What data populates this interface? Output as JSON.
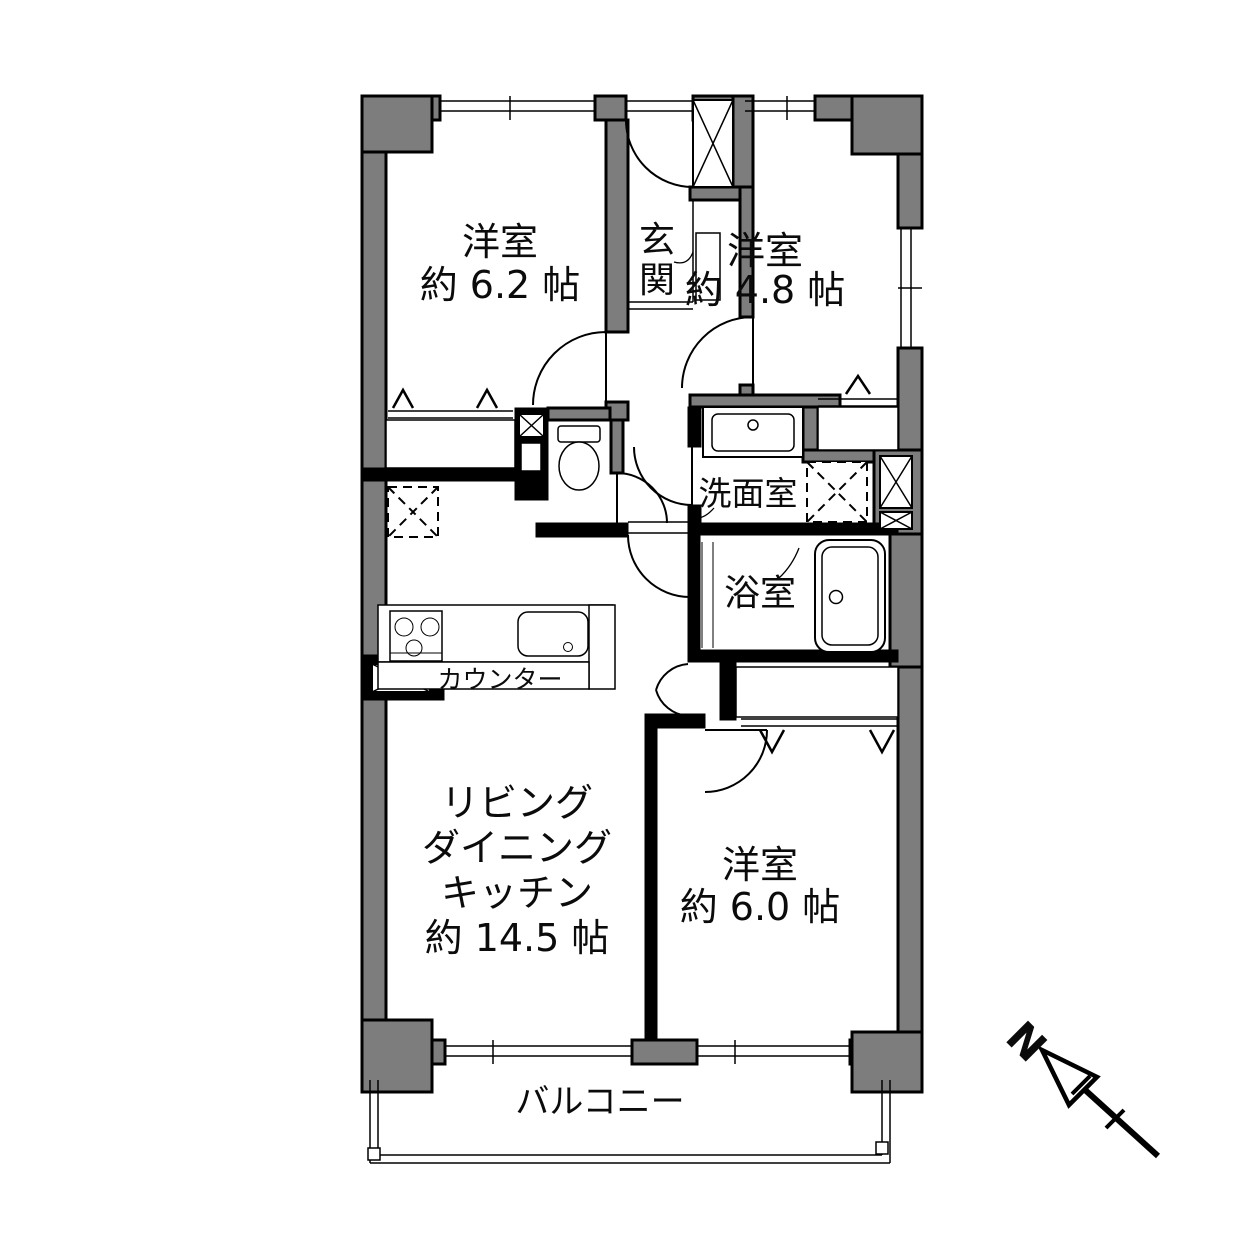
{
  "colors": {
    "wall_fill": "#7d7d7d",
    "wall_stroke": "#000000",
    "background": "#ffffff"
  },
  "rooms": {
    "bedroom1": {
      "name": "洋室",
      "area": "約 6.2 帖"
    },
    "bedroom2": {
      "name": "洋室",
      "area": "約 4.8 帖"
    },
    "bedroom3": {
      "name": "洋室",
      "area": "約 6.0 帖"
    },
    "ldk": {
      "line1": "リビング",
      "line2": "ダイニング",
      "line3": "キッチン",
      "area": "約 14.5 帖"
    },
    "entrance": {
      "char1": "玄",
      "char2": "関"
    },
    "washroom": {
      "name": "洗面室"
    },
    "bathroom": {
      "name": "浴室"
    },
    "balcony": {
      "name": "バルコニー"
    },
    "counter": {
      "name": "カウンター"
    }
  },
  "compass": {
    "north_label": "N"
  }
}
